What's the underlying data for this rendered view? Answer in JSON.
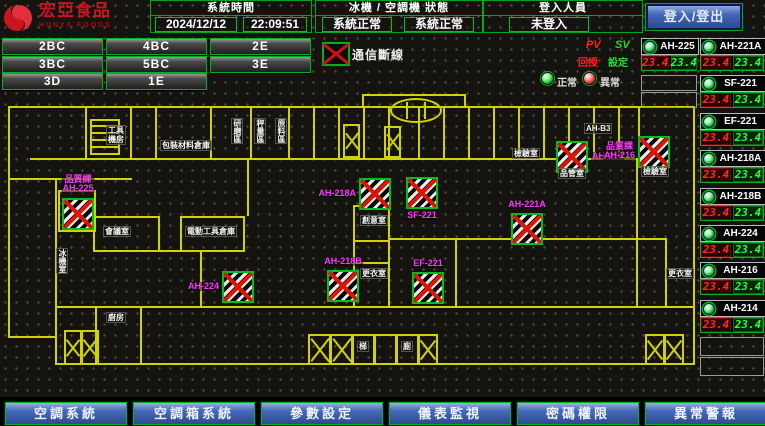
{
  "header": {
    "brand": "宏亞食品",
    "brand_en": "HUNYA FOODS",
    "system_time": {
      "label": "系統時間",
      "date": "2024/12/12",
      "time": "22:09:51"
    },
    "machine_status": {
      "label": "冰機 / 空調機 狀態",
      "chiller": "系統正常",
      "ahu": "系統正常"
    },
    "login": {
      "label": "登入人員",
      "value": "未登入",
      "button": "登入/登出"
    }
  },
  "floor_buttons": {
    "rows": [
      [
        "2BC",
        "4BC",
        "2E"
      ],
      [
        "3BC",
        "5BC",
        "3E"
      ],
      [
        "3D",
        "1E"
      ]
    ]
  },
  "legend": {
    "comm_error": "通信斷線",
    "pv": "PV",
    "sv": "SV",
    "pv_name": "回授",
    "sv_name": "設定",
    "normal": "正常",
    "abnormal": "異常"
  },
  "device_panel": {
    "left_column": [
      {
        "name": "AH-225",
        "pv": "23.4",
        "sv": "23.4"
      }
    ],
    "right_column": [
      {
        "name": "AH-221A",
        "pv": "23.4",
        "sv": "23.4"
      },
      {
        "name": "SF-221",
        "pv": "23.4",
        "sv": "23.4"
      },
      {
        "name": "EF-221",
        "pv": "23.4",
        "sv": "23.4"
      },
      {
        "name": "AH-218A",
        "pv": "23.4",
        "sv": "23.4"
      },
      {
        "name": "AH-218B",
        "pv": "23.4",
        "sv": "23.4"
      },
      {
        "name": "AH-224",
        "pv": "23.4",
        "sv": "23.4"
      },
      {
        "name": "AH-216",
        "pv": "23.4",
        "sv": "23.4"
      },
      {
        "name": "AH-214",
        "pv": "23.4",
        "sv": "23.4"
      }
    ]
  },
  "floor_plan": {
    "units": [
      {
        "id": "AH-225",
        "label": "品質課\nAH-225",
        "x": 62,
        "y": 198,
        "lp": "above"
      },
      {
        "id": "AH-224",
        "label": "AH-224",
        "x": 222,
        "y": 271,
        "lp": "left"
      },
      {
        "id": "AH-218B",
        "label": "AH-218B",
        "x": 327,
        "y": 270,
        "lp": "above"
      },
      {
        "id": "AH-218A",
        "label": "AH-218A",
        "x": 359,
        "y": 178,
        "lp": "left"
      },
      {
        "id": "SF-221",
        "label": "SF-221",
        "x": 406,
        "y": 177,
        "lp": "below"
      },
      {
        "id": "AH-214",
        "label": "AH-214",
        "x": 556,
        "y": 141,
        "lp": "right"
      },
      {
        "id": "AH-216",
        "label": "品質課\nAH-216",
        "x": 638,
        "y": 136,
        "lp": "left"
      },
      {
        "id": "AH-221A",
        "label": "AH-221A",
        "x": 511,
        "y": 213,
        "lp": "above"
      },
      {
        "id": "EF-221",
        "label": "EF-221",
        "x": 412,
        "y": 272,
        "lp": "above"
      }
    ],
    "rooms": [
      {
        "text": "工具\n機房",
        "x": 106,
        "y": 125
      },
      {
        "text": "包裝材料倉庫",
        "x": 160,
        "y": 140
      },
      {
        "text": "研磨區",
        "x": 231,
        "y": 118,
        "v": 1
      },
      {
        "text": "秤量區",
        "x": 254,
        "y": 118,
        "v": 1
      },
      {
        "text": "原料區",
        "x": 275,
        "y": 118,
        "v": 1
      },
      {
        "text": "AH-B3",
        "x": 584,
        "y": 123
      },
      {
        "text": "檢驗室",
        "x": 512,
        "y": 148
      },
      {
        "text": "品管室",
        "x": 558,
        "y": 168
      },
      {
        "text": "檢驗室",
        "x": 641,
        "y": 166
      },
      {
        "text": "會議室",
        "x": 103,
        "y": 226
      },
      {
        "text": "電動工具倉庫",
        "x": 185,
        "y": 226
      },
      {
        "text": "創意室",
        "x": 360,
        "y": 215
      },
      {
        "text": "更衣室",
        "x": 360,
        "y": 268
      },
      {
        "text": "更衣室",
        "x": 666,
        "y": 268
      },
      {
        "text": "冰機室",
        "x": 56,
        "y": 248,
        "v": 1
      },
      {
        "text": "廚房",
        "x": 106,
        "y": 312
      },
      {
        "text": "梯",
        "x": 357,
        "y": 341
      },
      {
        "text": "廁",
        "x": 401,
        "y": 341
      }
    ]
  },
  "bottom_nav": [
    "空調系統",
    "空調箱系統",
    "參數設定",
    "儀表監視",
    "密碼權限",
    "異常警報"
  ],
  "colors": {
    "accent_green": "#00b020",
    "alarm_red": "#dd1505",
    "magenta": "#ff35ff",
    "wall_yellow": "#d2d200",
    "button_blue": "#476aba"
  }
}
